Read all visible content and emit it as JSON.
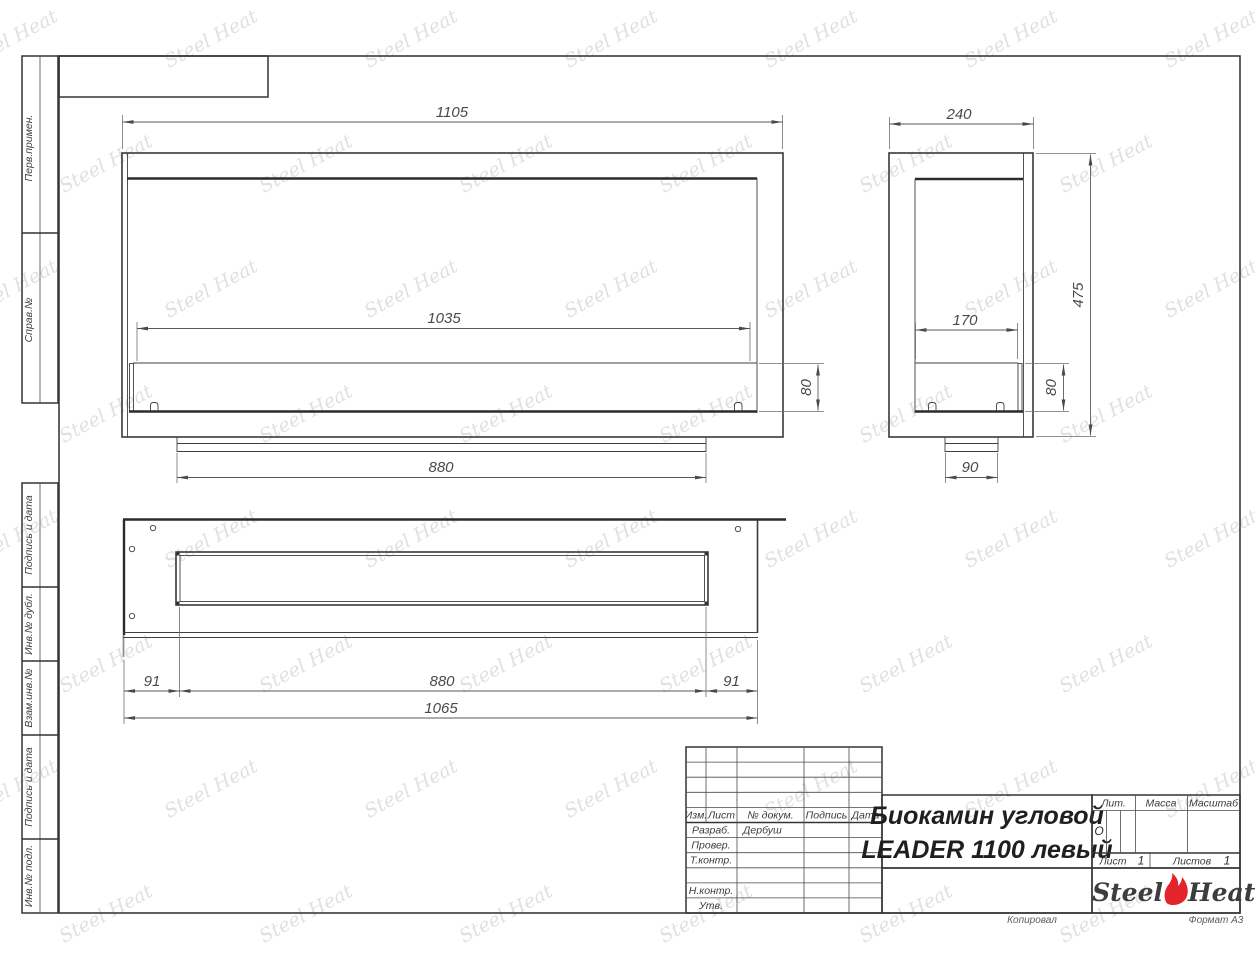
{
  "sheet": {
    "copied_note": "Копировал",
    "format_note": "Формат А3",
    "watermark_text": "Steel Heat"
  },
  "margin_labels": {
    "perv_primen": "Перв.примен.",
    "sprav_no": "Справ.№",
    "podpis_data_1": "Подпись и дата",
    "inv_no_dubl": "Инв.№ дубл.",
    "vzam_inv_no": "Взам.инв.№",
    "podpis_data_2": "Подпись и дата",
    "inv_no_podl": "Инв.№ подл."
  },
  "views": {
    "front": {
      "dims": {
        "overall_width": "1105",
        "opening_width": "1035",
        "fuel_block_height": "80",
        "base_width": "880"
      }
    },
    "side": {
      "dims": {
        "overall_depth": "240",
        "opening_depth": "170",
        "overall_height": "475",
        "fuel_block_height": "80",
        "base_depth": "90"
      }
    },
    "top": {
      "dims": {
        "left_margin": "91",
        "slot_length": "880",
        "right_margin": "91",
        "overall_length": "1065"
      }
    }
  },
  "title_block": {
    "columns": {
      "izm": "Изм.",
      "list": "Лист",
      "doc_no": "№ докум.",
      "podpis": "Подпись",
      "data": "Дата"
    },
    "rows": {
      "razrab_label": "Разраб.",
      "razrab_value": "Дербуш",
      "prover_label": "Провер.",
      "tkontr_label": "Т.контр.",
      "nkontr_label": "Н.контр.",
      "utv_label": "Утв."
    },
    "doc_title_line1": "Биокамин угловой",
    "doc_title_line2": "LEADER 1100 левый",
    "lit_label": "Лит.",
    "lit_value": "О",
    "mass_label": "Масса",
    "scale_label": "Масштаб",
    "list_label": "Лист",
    "list_value": "1",
    "listov_label": "Листов",
    "listov_value": "1",
    "logo": {
      "part1": "Steel",
      "part2": "Heat"
    }
  }
}
